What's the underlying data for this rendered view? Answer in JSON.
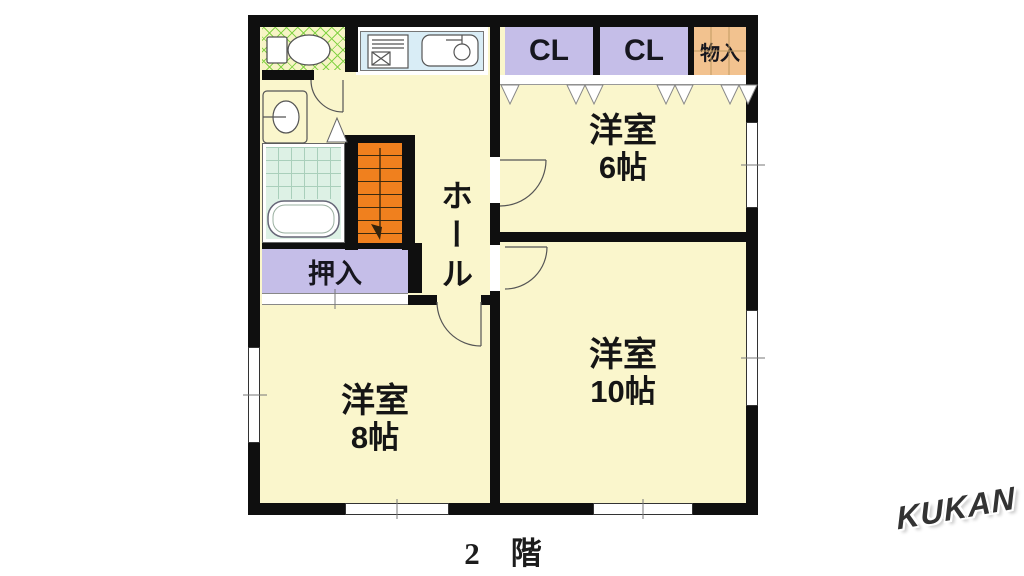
{
  "floor": {
    "title": "2　階"
  },
  "brand": {
    "logo": "KUKAN"
  },
  "rooms": {
    "hall": "ホール",
    "west6": {
      "name": "洋室",
      "size": "6帖"
    },
    "west10": {
      "name": "洋室",
      "size": "10帖"
    },
    "west8": {
      "name": "洋室",
      "size": "8帖"
    },
    "oshiire": "押入",
    "closet1": "CL",
    "closet2": "CL",
    "storage": "物入"
  },
  "fixtures": [
    "toilet-icon",
    "washbasin-icon",
    "bathtub-icon",
    "stove-icon",
    "kitchen-sink-icon",
    "staircase",
    "folding-door-chevrons",
    "door-swing-arcs",
    "windows"
  ],
  "colors": {
    "wall": "#0f0f0f",
    "floor": "#faf6cc",
    "closet": "#c5bee8",
    "storage": "#f2c28f",
    "stairs": "#f0801e",
    "mint": "#ddf1e5",
    "kitchen": "#d9edf6",
    "hatch": "#86d348"
  }
}
